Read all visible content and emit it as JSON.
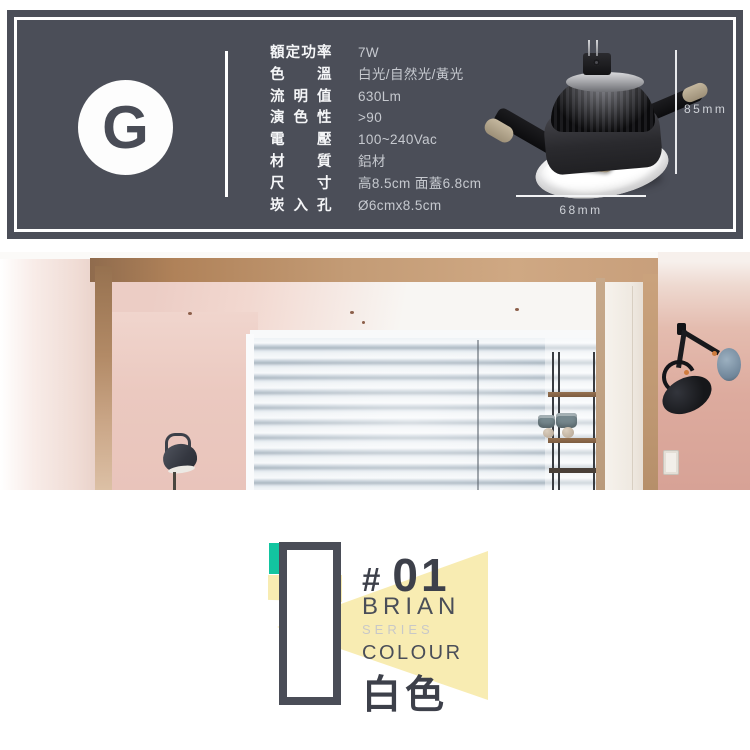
{
  "badge": {
    "letter": "G"
  },
  "specs": {
    "rows": [
      {
        "label": "額定功率",
        "value": "7W"
      },
      {
        "label": "色 溫",
        "value": "白光/自然光/黃光"
      },
      {
        "label": "流 明 值",
        "value": "630Lm"
      },
      {
        "label": "演 色 性",
        "value": ">90"
      },
      {
        "label": "電 壓",
        "value": "100~240Vac"
      },
      {
        "label": "材 質",
        "value": "鋁材"
      },
      {
        "label": "尺 寸",
        "value": "高8.5cm 面蓋6.8cm"
      },
      {
        "label": "崁 入 孔",
        "value": "Ø6cmx8.5cm"
      }
    ]
  },
  "dimensions": {
    "height_label": "85mm",
    "width_label": "68mm"
  },
  "brand": {
    "hash": "#",
    "number": "01",
    "name": "BRIAN",
    "series_label": "SERIES",
    "colour_label": "COLOUR",
    "colour_value": "白色"
  },
  "colors": {
    "panel_bg": "#4b4e58",
    "accent_teal": "#12c5a0",
    "accent_yellow": "#f8ecb2",
    "text_dark": "#3d404a"
  }
}
